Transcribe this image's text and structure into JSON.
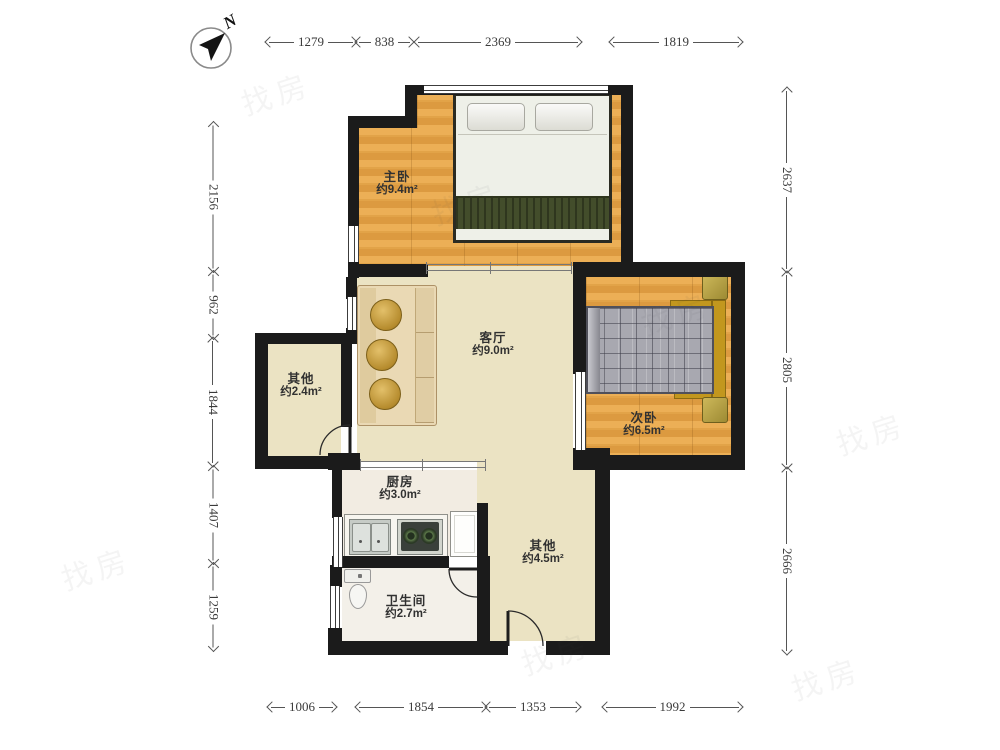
{
  "compass": {
    "label": "N"
  },
  "rooms": [
    {
      "id": "master-bedroom",
      "name": "主卧",
      "area": "约9.4m²"
    },
    {
      "id": "living-room",
      "name": "客厅",
      "area": "约9.0m²"
    },
    {
      "id": "second-bedroom",
      "name": "次卧",
      "area": "约6.5m²"
    },
    {
      "id": "other-small",
      "name": "其他",
      "area": "约2.4m²"
    },
    {
      "id": "kitchen",
      "name": "厨房",
      "area": "约3.0m²"
    },
    {
      "id": "bathroom",
      "name": "卫生间",
      "area": "约2.7m²"
    },
    {
      "id": "other-large",
      "name": "其他",
      "area": "约4.5m²"
    }
  ],
  "dimensions": {
    "top": [
      "1279",
      "838",
      "2369",
      "1819"
    ],
    "bottom": [
      "1006",
      "1854",
      "1353",
      "1992"
    ],
    "left": [
      "2156",
      "962",
      "1844",
      "1407",
      "1259"
    ],
    "right": [
      "2637",
      "2805",
      "2666"
    ]
  },
  "watermark": {
    "text": "找房"
  },
  "colors": {
    "wall": "#1b1b1b",
    "wood_floor": "#e2a14f",
    "living_floor": "#ebe3c3",
    "kitchen_floor": "#f2ece2",
    "bath_floor": "#f3f0e9",
    "blanket_green": "#434d2b",
    "plaid_gray": "#a8a8b0",
    "bedframe_gold": "#c2971e",
    "sofa_beige": "#ead9b4",
    "dimension_text": "#3a3a3a"
  }
}
